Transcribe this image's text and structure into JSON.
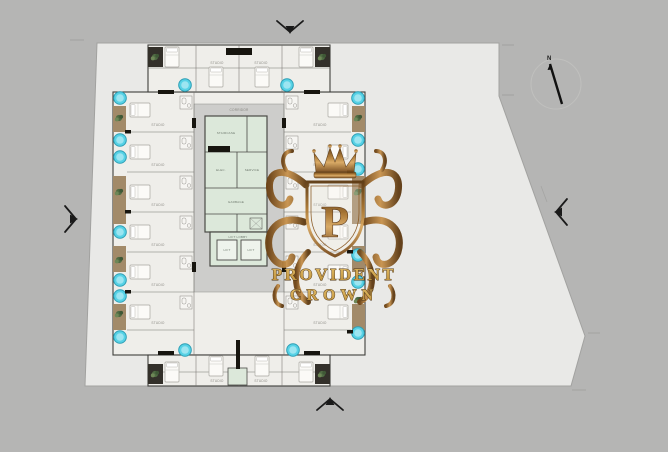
{
  "scene": {
    "type": "architectural floor plan screenshot",
    "description": "Typical residential tower floor plate with central lift core, studio units on all wings, balconies with round tubs, on an irregular plot"
  },
  "colors": {
    "background": "#b5b5b4",
    "plot": "#e9e9e7",
    "floor": "#efeeea",
    "corridor": "#cdcdcb",
    "core_room": "#dce8da",
    "water_tub": "#57d2e6",
    "balcony_wood": "#a28a69",
    "wall_dark": "#17150f",
    "gold": "#c9973c",
    "bronze": "#8a5a24"
  },
  "compass": {
    "label": "N"
  },
  "plan": {
    "unit_label": "STUDIO",
    "corridor_label": "CORRIDOR",
    "core": {
      "staircase": "STAIRCASE",
      "service_left": "ELEC.",
      "service_right": "SERVICE",
      "wide_room": "GARBAGE",
      "lobby": "LIFT LOBBY",
      "lift": "LIFT"
    }
  },
  "watermark": {
    "monogram": "P",
    "line1": "PROVIDENT",
    "line2": "CROWN"
  }
}
